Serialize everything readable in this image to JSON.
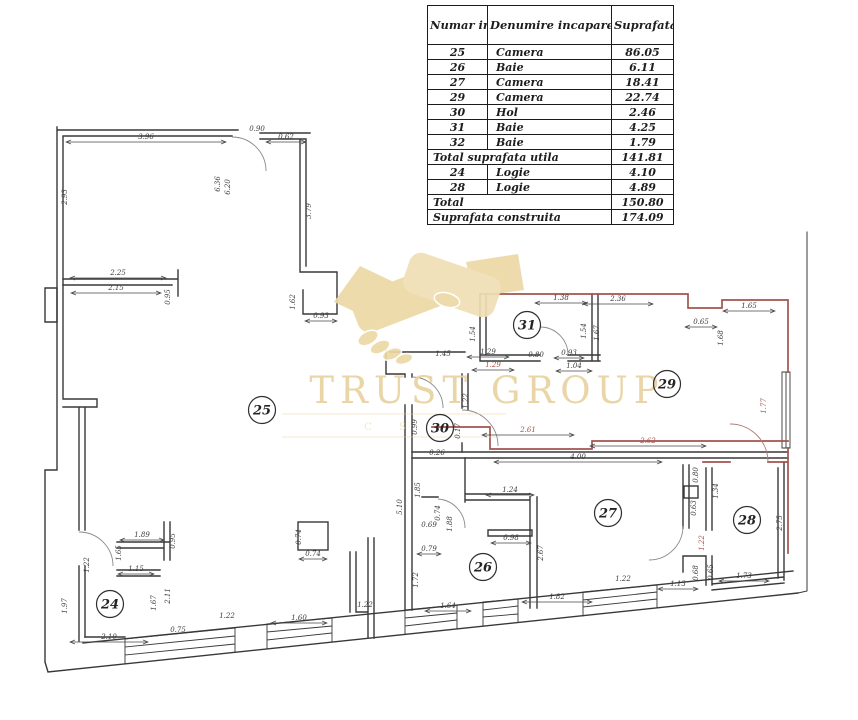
{
  "table": {
    "headers": [
      "Numar incapere",
      "Denumire incapare",
      "Suprafata utila (mp)"
    ],
    "rows": [
      {
        "num": "25",
        "name": "Camera",
        "value": "86.05"
      },
      {
        "num": "26",
        "name": "Baie",
        "value": "6.11"
      },
      {
        "num": "27",
        "name": "Camera",
        "value": "18.41"
      },
      {
        "num": "29",
        "name": "Camera",
        "value": "22.74"
      },
      {
        "num": "30",
        "name": "Hol",
        "value": "2.46"
      },
      {
        "num": "31",
        "name": "Baie",
        "value": "4.25"
      },
      {
        "num": "32",
        "name": "Baie",
        "value": "1.79"
      },
      {
        "label": "Total suprafata utila",
        "value": "141.81"
      },
      {
        "num": "24",
        "name": "Logie",
        "value": "4.10"
      },
      {
        "num": "28",
        "name": "Logie",
        "value": "4.89"
      },
      {
        "label": "Total",
        "value": "150.80"
      },
      {
        "label": "Suprafata construita",
        "value": "174.09"
      }
    ]
  },
  "watermark": {
    "title": "TRUST GROUP",
    "subtitle": "C S"
  },
  "plan": {
    "rooms": [
      {
        "n": "25",
        "x": 262,
        "y": 410
      },
      {
        "n": "30",
        "x": 440,
        "y": 428
      },
      {
        "n": "31",
        "x": 527,
        "y": 325
      },
      {
        "n": "29",
        "x": 667,
        "y": 384
      },
      {
        "n": "26",
        "x": 483,
        "y": 567
      },
      {
        "n": "27",
        "x": 608,
        "y": 513
      },
      {
        "n": "28",
        "x": 747,
        "y": 520
      },
      {
        "n": "24",
        "x": 110,
        "y": 604
      }
    ],
    "dims": [
      {
        "t": "3.96",
        "x": 146,
        "y": 139,
        "r": 0,
        "w": 160
      },
      {
        "t": "0.90",
        "x": 257,
        "y": 131,
        "r": 0
      },
      {
        "t": "0.62",
        "x": 286,
        "y": 139,
        "r": 0,
        "w": 40
      },
      {
        "t": "2.93",
        "x": 67,
        "y": 197,
        "r": 90
      },
      {
        "t": "6.36",
        "x": 220,
        "y": 184,
        "r": 90
      },
      {
        "t": "6.20",
        "x": 230,
        "y": 187,
        "r": 90
      },
      {
        "t": "3.79",
        "x": 311,
        "y": 211,
        "r": 90
      },
      {
        "t": "2.25",
        "x": 118,
        "y": 275,
        "r": 0,
        "w": 96
      },
      {
        "t": "2.15",
        "x": 116,
        "y": 290,
        "r": 0,
        "w": 90
      },
      {
        "t": "0.95",
        "x": 170,
        "y": 297,
        "r": 90
      },
      {
        "t": "1.62",
        "x": 295,
        "y": 302,
        "r": 90
      },
      {
        "t": "0.93",
        "x": 321,
        "y": 318,
        "r": 0,
        "w": 32
      },
      {
        "t": "1.45",
        "x": 443,
        "y": 356,
        "r": 0
      },
      {
        "t": "1.29",
        "x": 488,
        "y": 354,
        "r": 0,
        "w": 42
      },
      {
        "t": "0.80",
        "x": 536,
        "y": 357,
        "r": 0
      },
      {
        "t": "0.93",
        "x": 569,
        "y": 355,
        "r": 0,
        "w": 30
      },
      {
        "t": "1.38",
        "x": 561,
        "y": 300,
        "r": 0,
        "w": 52
      },
      {
        "t": "2.36",
        "x": 618,
        "y": 301,
        "r": 0,
        "w": 70
      },
      {
        "t": "1.65",
        "x": 749,
        "y": 308,
        "r": 0,
        "w": 52
      },
      {
        "t": "0.65",
        "x": 701,
        "y": 324,
        "r": 0,
        "w": 32
      },
      {
        "t": "1.68",
        "x": 723,
        "y": 338,
        "r": 90
      },
      {
        "t": "1.54",
        "x": 586,
        "y": 331,
        "r": 90
      },
      {
        "t": "1.67",
        "x": 599,
        "y": 333,
        "r": 90
      },
      {
        "t": "1.54",
        "x": 475,
        "y": 334,
        "r": 90
      },
      {
        "t": "1.29",
        "x": 493,
        "y": 367,
        "r": 0,
        "w": 42,
        "c": "r"
      },
      {
        "t": "1.04",
        "x": 574,
        "y": 368,
        "r": 0,
        "w": 36
      },
      {
        "t": "1.77",
        "x": 766,
        "y": 406,
        "r": 90,
        "c": "r"
      },
      {
        "t": "1.22",
        "x": 468,
        "y": 401,
        "r": 90
      },
      {
        "t": "0.99",
        "x": 417,
        "y": 427,
        "r": 90
      },
      {
        "t": "0.17",
        "x": 460,
        "y": 431,
        "r": 90
      },
      {
        "t": "2.61",
        "x": 528,
        "y": 432,
        "r": 0,
        "w": 92,
        "c": "r"
      },
      {
        "t": "4.00",
        "x": 578,
        "y": 459,
        "r": 0,
        "w": 168
      },
      {
        "t": "2.62",
        "x": 648,
        "y": 443,
        "r": 0,
        "w": 116,
        "c": "r"
      },
      {
        "t": "0.80",
        "x": 698,
        "y": 475,
        "r": 90
      },
      {
        "t": "5.10",
        "x": 402,
        "y": 507,
        "r": 90
      },
      {
        "t": "1.85",
        "x": 420,
        "y": 490,
        "r": 90
      },
      {
        "t": "0.74",
        "x": 301,
        "y": 537,
        "r": 90
      },
      {
        "t": "0.74",
        "x": 313,
        "y": 556,
        "r": 0,
        "w": 28
      },
      {
        "t": "1.24",
        "x": 510,
        "y": 492,
        "r": 0,
        "w": 48
      },
      {
        "t": "0.98",
        "x": 511,
        "y": 540,
        "r": 0,
        "w": 40
      },
      {
        "t": "2.67",
        "x": 543,
        "y": 553,
        "r": 90
      },
      {
        "t": "0.74",
        "x": 440,
        "y": 513,
        "r": 90
      },
      {
        "t": "0.69",
        "x": 429,
        "y": 527,
        "r": 0
      },
      {
        "t": "1.88",
        "x": 452,
        "y": 524,
        "r": 90
      },
      {
        "t": "0.79",
        "x": 429,
        "y": 551,
        "r": 0,
        "w": 24
      },
      {
        "t": "1.72",
        "x": 418,
        "y": 580,
        "r": 90
      },
      {
        "t": "0.26",
        "x": 437,
        "y": 455,
        "r": 0
      },
      {
        "t": "1.64",
        "x": 448,
        "y": 608,
        "r": 0,
        "w": 46
      },
      {
        "t": "1.82",
        "x": 557,
        "y": 599,
        "r": 0,
        "w": 70
      },
      {
        "t": "1.22",
        "x": 623,
        "y": 581,
        "r": 0
      },
      {
        "t": "1.13",
        "x": 678,
        "y": 586,
        "r": 0,
        "w": 40
      },
      {
        "t": "0.68",
        "x": 698,
        "y": 573,
        "r": 90
      },
      {
        "t": "0.65",
        "x": 713,
        "y": 572,
        "r": 90
      },
      {
        "t": "1.73",
        "x": 744,
        "y": 578,
        "r": 0,
        "w": 50
      },
      {
        "t": "2.75",
        "x": 782,
        "y": 523,
        "r": 90
      },
      {
        "t": "1.34",
        "x": 718,
        "y": 491,
        "r": 90
      },
      {
        "t": "0.63",
        "x": 696,
        "y": 508,
        "r": 90
      },
      {
        "t": "1.22",
        "x": 704,
        "y": 543,
        "r": 90,
        "c": "r"
      },
      {
        "t": "1.97",
        "x": 67,
        "y": 606,
        "r": 90
      },
      {
        "t": "1.89",
        "x": 142,
        "y": 537,
        "r": 0,
        "w": 44
      },
      {
        "t": "0.95",
        "x": 175,
        "y": 541,
        "r": 90
      },
      {
        "t": "1.65",
        "x": 121,
        "y": 553,
        "r": 90
      },
      {
        "t": "1.15",
        "x": 136,
        "y": 571,
        "r": 0,
        "w": 36
      },
      {
        "t": "1.67",
        "x": 156,
        "y": 603,
        "r": 90
      },
      {
        "t": "2.11",
        "x": 170,
        "y": 596,
        "r": 90
      },
      {
        "t": "1.22",
        "x": 89,
        "y": 565,
        "r": 90
      },
      {
        "t": "2.10",
        "x": 109,
        "y": 639,
        "r": 0,
        "w": 78
      },
      {
        "t": "0.75",
        "x": 178,
        "y": 632,
        "r": 0
      },
      {
        "t": "1.22",
        "x": 227,
        "y": 618,
        "r": 0
      },
      {
        "t": "1.60",
        "x": 299,
        "y": 620,
        "r": 0,
        "w": 56
      },
      {
        "t": "1.22",
        "x": 365,
        "y": 607,
        "r": 0
      }
    ]
  }
}
